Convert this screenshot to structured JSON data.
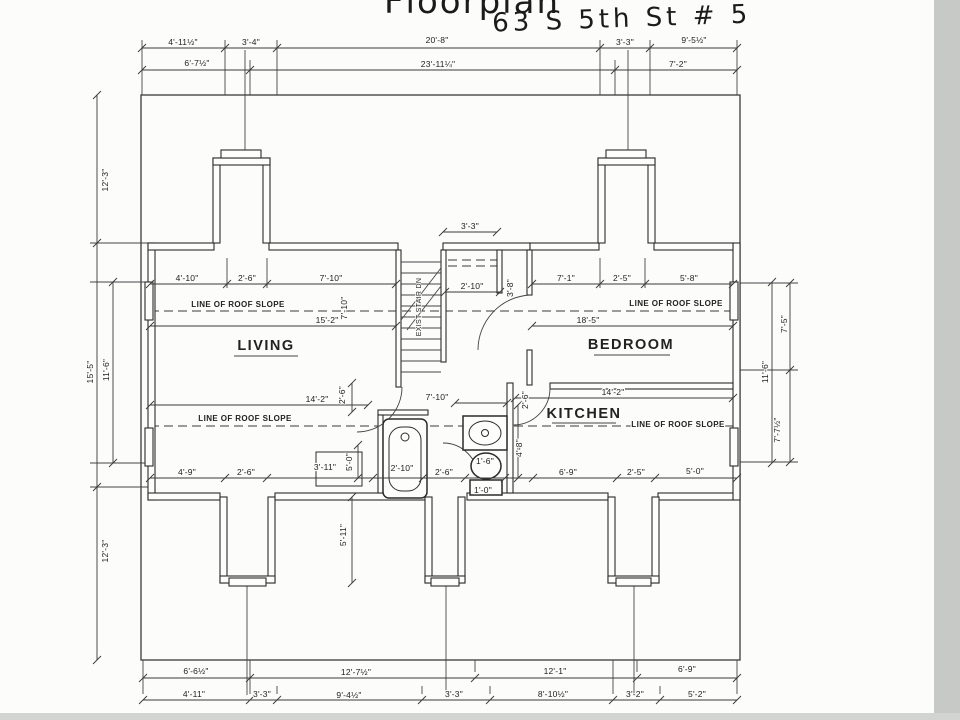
{
  "title": {
    "line1": "Floorplan",
    "line2": "63 S 5th St # 5"
  },
  "rooms": [
    "LIVING",
    "BEDROOM",
    "KITCHEN"
  ],
  "stairs_text": "EXIST STAIR DN",
  "roof_text": "LINE OF ROOF SLOPE",
  "colors": {
    "ink": "#2b2b2b",
    "paper": "#fcfcfa",
    "scan_edge": "#c7c9c6"
  },
  "labels": [
    {
      "name": "title-line1",
      "text": "Floorplan",
      "x": 472,
      "y": 13,
      "cls": "hand1"
    },
    {
      "name": "title-line2",
      "text": "63 S 5th St # 5",
      "x": 622,
      "y": 27,
      "cls": "hand2",
      "rot": -2
    },
    {
      "text": "4'-11½\"",
      "x": 183,
      "y": 45
    },
    {
      "text": "3'-4\"",
      "x": 251,
      "y": 45
    },
    {
      "text": "20'-8\"",
      "x": 437,
      "y": 43
    },
    {
      "text": "3'-3\"",
      "x": 625,
      "y": 45
    },
    {
      "text": "9'-5½\"",
      "x": 694,
      "y": 43
    },
    {
      "text": "6'-7½\"",
      "x": 197,
      "y": 66
    },
    {
      "text": "23'-11¼\"",
      "x": 438,
      "y": 67
    },
    {
      "text": "7'-2\"",
      "x": 678,
      "y": 67
    },
    {
      "text": "12'-3\"",
      "x": 108,
      "y": 180,
      "rot": -90
    },
    {
      "text": "15'-5\"",
      "x": 93,
      "y": 372,
      "rot": -90
    },
    {
      "text": "11'-6\"",
      "x": 109,
      "y": 370,
      "rot": -90
    },
    {
      "text": "12'-3\"",
      "x": 108,
      "y": 551,
      "rot": -90
    },
    {
      "text": "7'-5\"",
      "x": 787,
      "y": 324,
      "rot": -90
    },
    {
      "text": "11'-6\"",
      "x": 768,
      "y": 372,
      "rot": -90
    },
    {
      "text": "7'-7½\"",
      "x": 780,
      "y": 430,
      "rot": -90
    },
    {
      "text": "6'-6½\"",
      "x": 196,
      "y": 674
    },
    {
      "text": "12'-7½\"",
      "x": 356,
      "y": 675
    },
    {
      "text": "12'-1\"",
      "x": 555,
      "y": 674
    },
    {
      "text": "6'-9\"",
      "x": 687,
      "y": 672
    },
    {
      "text": "4'-11\"",
      "x": 194,
      "y": 697
    },
    {
      "text": "3'-3\"",
      "x": 262,
      "y": 697
    },
    {
      "text": "9'-4½\"",
      "x": 349,
      "y": 698
    },
    {
      "text": "3'-3\"",
      "x": 454,
      "y": 697
    },
    {
      "text": "8'-10½\"",
      "x": 553,
      "y": 697
    },
    {
      "text": "3'-2\"",
      "x": 635,
      "y": 697
    },
    {
      "text": "5'-2\"",
      "x": 697,
      "y": 697
    },
    {
      "text": "4'-10\"",
      "x": 187,
      "y": 281
    },
    {
      "text": "2'-6\"",
      "x": 247,
      "y": 281
    },
    {
      "text": "7'-10\"",
      "x": 331,
      "y": 281
    },
    {
      "text": "15'-2\"",
      "x": 327,
      "y": 323
    },
    {
      "text": "7'-10\"",
      "x": 347,
      "y": 308,
      "rot": -90
    },
    {
      "text": "7'-1\"",
      "x": 566,
      "y": 281
    },
    {
      "text": "2'-5\"",
      "x": 622,
      "y": 281
    },
    {
      "text": "5'-8\"",
      "x": 689,
      "y": 281
    },
    {
      "text": "18'-5\"",
      "x": 588,
      "y": 323
    },
    {
      "text": "3'-8\"",
      "x": 513,
      "y": 288,
      "rot": -90
    },
    {
      "text": "3'-3\"",
      "x": 470,
      "y": 229
    },
    {
      "text": "2'-10\"",
      "x": 472,
      "y": 289
    },
    {
      "text": "14'-2\"",
      "x": 317,
      "y": 402
    },
    {
      "text": "2'-6\"",
      "x": 345,
      "y": 395,
      "rot": -90
    },
    {
      "text": "7'-10\"",
      "x": 437,
      "y": 400
    },
    {
      "text": "2'-6\"",
      "x": 528,
      "y": 400,
      "rot": -90
    },
    {
      "text": "14'-2\"",
      "x": 613,
      "y": 395
    },
    {
      "text": "4'-9\"",
      "x": 187,
      "y": 475
    },
    {
      "text": "2'-6\"",
      "x": 246,
      "y": 475
    },
    {
      "text": "3'-11\"",
      "x": 325,
      "y": 470
    },
    {
      "text": "5'-0\"",
      "x": 352,
      "y": 462,
      "rot": -90
    },
    {
      "text": "2'-10\"",
      "x": 402,
      "y": 471
    },
    {
      "text": "2'-6\"",
      "x": 444,
      "y": 475
    },
    {
      "text": "1'-6\"",
      "x": 485,
      "y": 464
    },
    {
      "text": "4'-8\"",
      "x": 522,
      "y": 448,
      "rot": -90
    },
    {
      "text": "6'-9\"",
      "x": 568,
      "y": 475
    },
    {
      "text": "2'-5\"",
      "x": 636,
      "y": 475
    },
    {
      "text": "5'-0\"",
      "x": 695,
      "y": 474
    },
    {
      "text": "1'-0\"",
      "x": 483,
      "y": 493
    },
    {
      "text": "5'-11\"",
      "x": 346,
      "y": 535,
      "rot": -90
    },
    {
      "name": "room-label-living",
      "text": "LIVING",
      "x": 266,
      "y": 350,
      "cls": "room"
    },
    {
      "name": "room-label-bedroom",
      "text": "BEDROOM",
      "x": 631,
      "y": 349,
      "cls": "room"
    },
    {
      "name": "room-label-kitchen",
      "text": "KITCHEN",
      "x": 584,
      "y": 418,
      "cls": "room"
    },
    {
      "name": "roof-slope-label",
      "text": "LINE OF ROOF SLOPE",
      "x": 238,
      "y": 307,
      "cls": "roof"
    },
    {
      "name": "roof-slope-label",
      "text": "LINE OF ROOF SLOPE",
      "x": 676,
      "y": 306,
      "cls": "roof"
    },
    {
      "name": "roof-slope-label",
      "text": "LINE OF ROOF SLOPE",
      "x": 245,
      "y": 421,
      "cls": "roof"
    },
    {
      "name": "roof-slope-label",
      "text": "LINE OF ROOF SLOPE",
      "x": 678,
      "y": 427,
      "cls": "roof"
    },
    {
      "name": "stair-label",
      "text": "EXIST STAIR DN",
      "x": 421,
      "y": 307,
      "rot": -90,
      "cls": "stair"
    }
  ],
  "dimensions": [
    {
      "o": "h",
      "pos": 48,
      "from": 142,
      "to": 737,
      "ticks": [
        142,
        225,
        277,
        600,
        650,
        737
      ]
    },
    {
      "o": "h",
      "pos": 70,
      "from": 142,
      "to": 737,
      "ticks": [
        142,
        250,
        615,
        737
      ]
    },
    {
      "o": "h",
      "pos": 678,
      "from": 143,
      "to": 737,
      "ticks": [
        143,
        250,
        475,
        637,
        737
      ]
    },
    {
      "o": "h",
      "pos": 700,
      "from": 143,
      "to": 737,
      "ticks": [
        143,
        250,
        277,
        422,
        490,
        613,
        660,
        737
      ]
    },
    {
      "o": "v",
      "pos": 97,
      "from": 95,
      "to": 660,
      "ticks": [
        95,
        243,
        487,
        660
      ]
    },
    {
      "o": "v",
      "pos": 113,
      "from": 282,
      "to": 463,
      "ticks": [
        282,
        463
      ]
    },
    {
      "o": "v",
      "pos": 790,
      "from": 283,
      "to": 462,
      "ticks": [
        283,
        370,
        462
      ]
    },
    {
      "o": "v",
      "pos": 772,
      "from": 282,
      "to": 463,
      "ticks": [
        282,
        463
      ]
    },
    {
      "o": "h",
      "pos": 284,
      "from": 150,
      "to": 396,
      "ticks": [
        150,
        227,
        267,
        396
      ]
    },
    {
      "o": "h",
      "pos": 326,
      "from": 150,
      "to": 396,
      "ticks": [
        150,
        396
      ]
    },
    {
      "o": "h",
      "pos": 284,
      "from": 532,
      "to": 733,
      "ticks": [
        532,
        600,
        645,
        733
      ]
    },
    {
      "o": "h",
      "pos": 326,
      "from": 532,
      "to": 733,
      "ticks": [
        532,
        733
      ]
    },
    {
      "o": "h",
      "pos": 232,
      "from": 443,
      "to": 497,
      "ticks": [
        443,
        497
      ]
    },
    {
      "o": "h",
      "pos": 292,
      "from": 445,
      "to": 500,
      "ticks": [
        445,
        500
      ]
    },
    {
      "o": "h",
      "pos": 405,
      "from": 150,
      "to": 368,
      "ticks": [
        150,
        368
      ]
    },
    {
      "o": "v",
      "pos": 352,
      "from": 383,
      "to": 412,
      "ticks": [
        383,
        412
      ]
    },
    {
      "o": "h",
      "pos": 403,
      "from": 455,
      "to": 507,
      "ticks": [
        455,
        507
      ]
    },
    {
      "o": "h",
      "pos": 398,
      "from": 515,
      "to": 733,
      "ticks": [
        515,
        733
      ]
    },
    {
      "o": "h",
      "pos": 478,
      "from": 150,
      "to": 737,
      "ticks": [
        150,
        225,
        267,
        373,
        423,
        465,
        505,
        533,
        617,
        655,
        737
      ]
    },
    {
      "o": "v",
      "pos": 358,
      "from": 445,
      "to": 478,
      "ticks": [
        445,
        478
      ]
    },
    {
      "o": "v",
      "pos": 518,
      "from": 405,
      "to": 478,
      "ticks": [
        405,
        478
      ]
    },
    {
      "o": "v",
      "pos": 352,
      "from": 497,
      "to": 583,
      "ticks": [
        497,
        583
      ]
    }
  ],
  "thin_lines": [
    [
      142,
      40,
      142,
      95
    ],
    [
      225,
      40,
      225,
      95
    ],
    [
      277,
      40,
      277,
      95
    ],
    [
      600,
      40,
      600,
      95
    ],
    [
      650,
      40,
      650,
      95
    ],
    [
      737,
      40,
      737,
      95
    ],
    [
      250,
      60,
      250,
      95
    ],
    [
      615,
      60,
      615,
      95
    ],
    [
      245,
      50,
      245,
      158
    ],
    [
      628,
      50,
      628,
      158
    ],
    [
      90,
      243,
      148,
      243
    ],
    [
      90,
      282,
      148,
      282
    ],
    [
      90,
      463,
      148,
      463
    ],
    [
      90,
      487,
      148,
      487
    ],
    [
      740,
      283,
      798,
      283
    ],
    [
      740,
      370,
      798,
      370
    ],
    [
      740,
      462,
      798,
      462
    ],
    [
      143,
      660,
      143,
      694
    ],
    [
      250,
      660,
      250,
      694
    ],
    [
      277,
      686,
      277,
      694
    ],
    [
      422,
      686,
      422,
      694
    ],
    [
      475,
      660,
      475,
      672
    ],
    [
      490,
      686,
      490,
      694
    ],
    [
      613,
      660,
      613,
      694
    ],
    [
      637,
      660,
      637,
      672
    ],
    [
      660,
      686,
      660,
      694
    ],
    [
      737,
      660,
      737,
      694
    ],
    [
      247,
      583,
      247,
      695
    ],
    [
      446,
      583,
      446,
      695
    ],
    [
      634,
      583,
      634,
      695
    ],
    [
      227,
      258,
      227,
      288
    ],
    [
      267,
      258,
      267,
      288
    ],
    [
      600,
      258,
      600,
      288
    ],
    [
      645,
      258,
      645,
      288
    ]
  ],
  "dashed_lines": [
    [
      150,
      311,
      733,
      311
    ],
    [
      150,
      426,
      733,
      426
    ],
    [
      448,
      260,
      502,
      260
    ],
    [
      448,
      266,
      502,
      266
    ]
  ]
}
